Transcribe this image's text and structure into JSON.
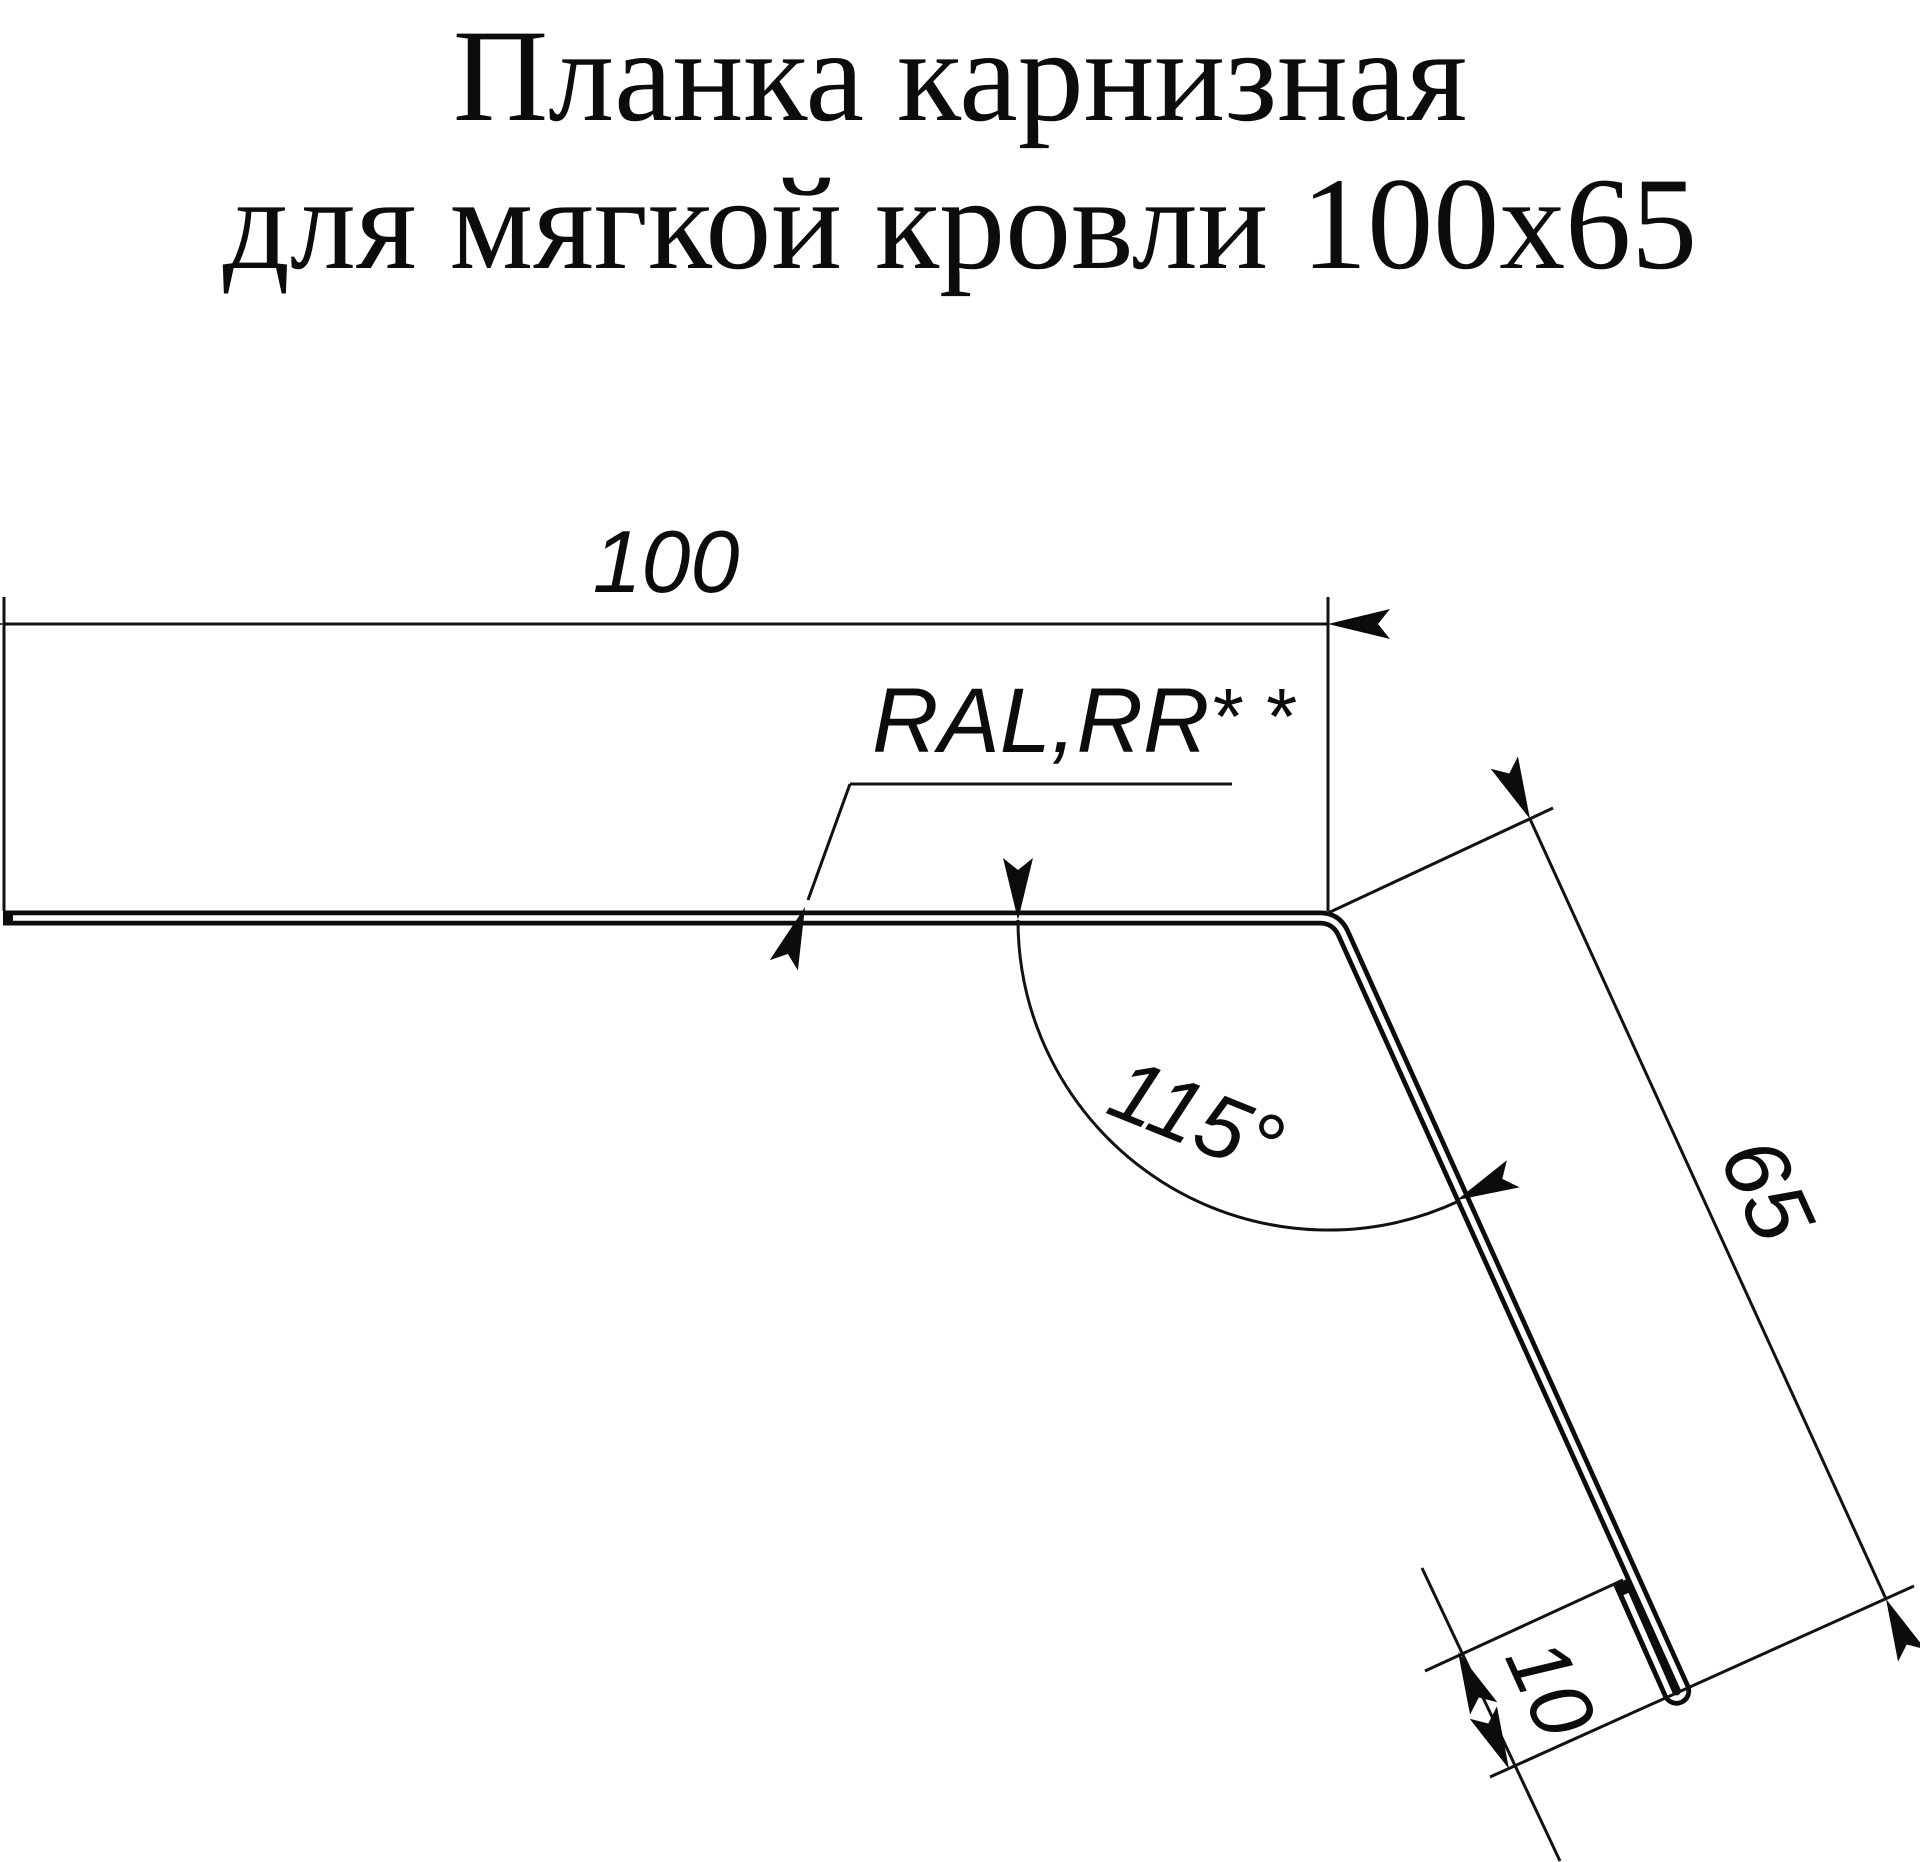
{
  "title": {
    "line1": "Планка карнизная",
    "line2": "для мягкой кровли 100х65"
  },
  "drawing": {
    "type": "technical-profile-drawing",
    "part": "eaves strip (карнизная планка) for soft roofing, cross-section profile",
    "dimensions": {
      "top_flange_width": {
        "value": "100",
        "units": "mm"
      },
      "drop_face_length": {
        "value": "65",
        "units": "mm"
      },
      "hem_fold": {
        "value": "10",
        "units": "mm"
      },
      "bend_angle": {
        "value": "115°"
      }
    },
    "coating_label": "RAL,RR",
    "coating_note_marks": "* *",
    "colors": {
      "line": "#0c0c0c",
      "background": "#ffffff"
    }
  }
}
